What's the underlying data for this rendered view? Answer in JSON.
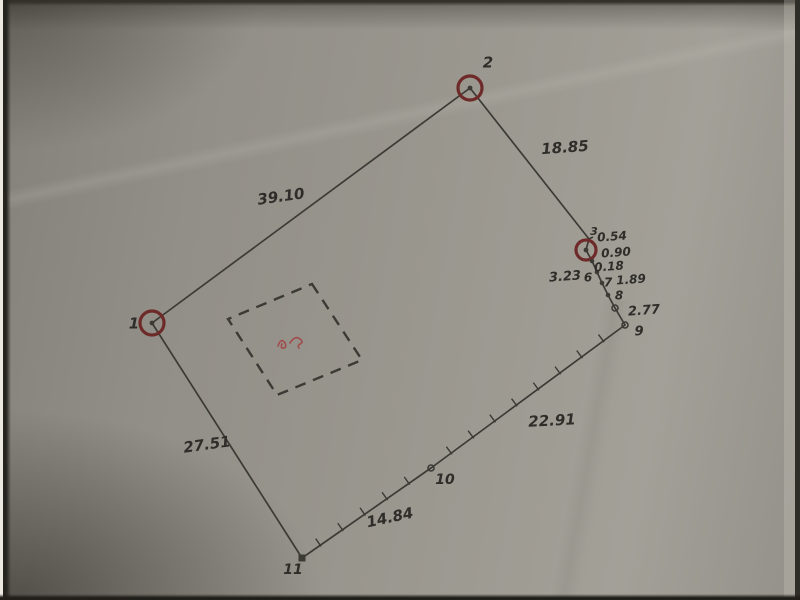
{
  "style": {
    "line_color": "#3c3a35",
    "label_color": "#2e2d29",
    "circle_color": "#6e2a28",
    "red_ink_color": "#a14e4e",
    "paper_base": "#96938b"
  },
  "chart_data": {
    "type": "diagram",
    "subtype": "scanned-land-survey-plot-plan",
    "points": [
      {
        "id": "1",
        "x": 152,
        "y": 323,
        "marker": "circled",
        "label": {
          "text": "1",
          "x": 134,
          "y": 324,
          "size": 15
        }
      },
      {
        "id": "2",
        "x": 470,
        "y": 88,
        "marker": "circled",
        "label": {
          "text": "2",
          "x": 488,
          "y": 63,
          "size": 15
        }
      },
      {
        "id": "3",
        "x": 589,
        "y": 239,
        "marker": "tick",
        "label": {
          "text": "3",
          "x": 594,
          "y": 232,
          "size": 11
        }
      },
      {
        "id": "4",
        "x": 586,
        "y": 250,
        "marker": "circled-small",
        "label": null
      },
      {
        "id": "5",
        "x": 592,
        "y": 261,
        "marker": "dot",
        "label": null
      },
      {
        "id": "6",
        "x": 597,
        "y": 272,
        "marker": "dot",
        "label": {
          "text": "6",
          "x": 588,
          "y": 278,
          "size": 12
        }
      },
      {
        "id": "7",
        "x": 602,
        "y": 283,
        "marker": "dot",
        "label": {
          "text": "7",
          "x": 608,
          "y": 283,
          "size": 12
        }
      },
      {
        "id": "8",
        "x": 608,
        "y": 295,
        "marker": "dot",
        "label": {
          "text": "8",
          "x": 619,
          "y": 296,
          "size": 12
        }
      },
      {
        "id": "p89",
        "x": 615,
        "y": 308,
        "marker": "circle",
        "label": null
      },
      {
        "id": "9",
        "x": 625,
        "y": 325,
        "marker": "circle",
        "label": {
          "text": "9",
          "x": 639,
          "y": 332,
          "size": 13
        }
      },
      {
        "id": "10",
        "x": 431,
        "y": 468,
        "marker": "circle",
        "label": {
          "text": "10",
          "x": 445,
          "y": 480,
          "size": 14
        }
      },
      {
        "id": "11",
        "x": 302,
        "y": 558,
        "marker": "square",
        "label": {
          "text": "11",
          "x": 293,
          "y": 570,
          "size": 14
        }
      }
    ],
    "edges": [
      {
        "from": "1",
        "to": "2",
        "style": "plain"
      },
      {
        "from": "2",
        "to": "3",
        "style": "plain"
      },
      {
        "from": "3",
        "to": "4",
        "style": "plain"
      },
      {
        "from": "4",
        "to": "5",
        "style": "plain"
      },
      {
        "from": "5",
        "to": "6",
        "style": "plain"
      },
      {
        "from": "6",
        "to": "7",
        "style": "plain"
      },
      {
        "from": "7",
        "to": "8",
        "style": "plain"
      },
      {
        "from": "8",
        "to": "p89",
        "style": "plain"
      },
      {
        "from": "p89",
        "to": "9",
        "style": "plain"
      },
      {
        "from": "9",
        "to": "10",
        "style": "hatched"
      },
      {
        "from": "10",
        "to": "11",
        "style": "hatched"
      },
      {
        "from": "11",
        "to": "1",
        "style": "plain"
      }
    ],
    "distance_labels": [
      {
        "text": "39.10",
        "x": 281,
        "y": 197,
        "rot": -8,
        "size": 15
      },
      {
        "text": "18.85",
        "x": 565,
        "y": 148,
        "rot": -4,
        "size": 15
      },
      {
        "text": "0.54",
        "x": 612,
        "y": 237,
        "rot": -4,
        "size": 12
      },
      {
        "text": "0.90",
        "x": 616,
        "y": 253,
        "rot": -4,
        "size": 12
      },
      {
        "text": "0.18",
        "x": 609,
        "y": 267,
        "rot": -4,
        "size": 12
      },
      {
        "text": "3.23",
        "x": 565,
        "y": 277,
        "rot": -4,
        "size": 13
      },
      {
        "text": "1.89",
        "x": 631,
        "y": 280,
        "rot": -4,
        "size": 12
      },
      {
        "text": "2.77",
        "x": 644,
        "y": 311,
        "rot": -4,
        "size": 13
      },
      {
        "text": "22.91",
        "x": 552,
        "y": 421,
        "rot": -3,
        "size": 15
      },
      {
        "text": "14.84",
        "x": 390,
        "y": 518,
        "rot": -12,
        "size": 15
      },
      {
        "text": "27.51",
        "x": 207,
        "y": 445,
        "rot": -8,
        "size": 15
      }
    ],
    "dashed_square": {
      "corners": [
        [
          312,
          284
        ],
        [
          362,
          360
        ],
        [
          277,
          395
        ],
        [
          228,
          319
        ]
      ],
      "dash": "11 8"
    },
    "red_annotation": {
      "x": 293,
      "y": 341
    }
  }
}
